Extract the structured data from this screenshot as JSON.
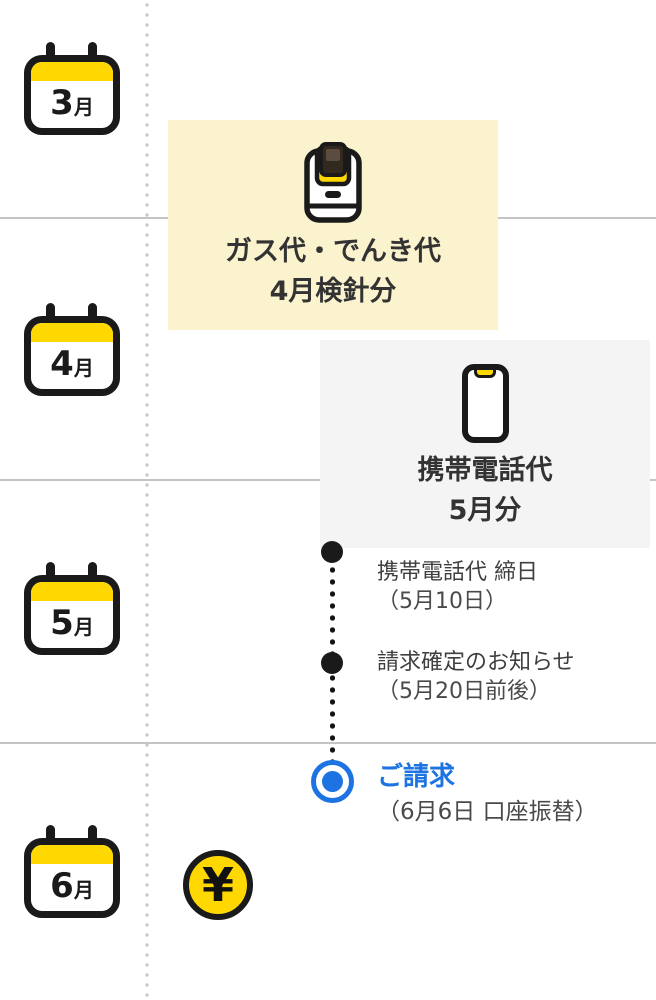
{
  "months": [
    {
      "num": "3",
      "unit": "月"
    },
    {
      "num": "4",
      "unit": "月"
    },
    {
      "num": "5",
      "unit": "月"
    },
    {
      "num": "6",
      "unit": "月"
    }
  ],
  "cards": [
    {
      "name": "gas-electric",
      "icon": "gas-meter-icon",
      "line1": "ガス代・でんき代",
      "line2": "4月検針分",
      "bg": "#FAF3CE"
    },
    {
      "name": "mobile-phone",
      "icon": "smartphone-icon",
      "line1": "携帯電話代",
      "line2": "5月分",
      "bg": "#F4F4F4"
    }
  ],
  "events": [
    {
      "marker": "black-dot",
      "label": "携帯電話代 締日",
      "date": "（5月10日）"
    },
    {
      "marker": "black-dot",
      "label": "請求確定のお知らせ",
      "date": "（5月20日前後）"
    },
    {
      "marker": "blue-target-dot",
      "label": "ご請求",
      "date": "（6月6日 口座振替）"
    }
  ],
  "coin": {
    "symbol": "¥"
  },
  "colors": {
    "accent_yellow": "#FFD802",
    "pale_yellow_card": "#FAF3CE",
    "gray_card": "#F4F4F4",
    "ink": "#1A1A1A",
    "text": "#3F3F3F",
    "blue": "#1D73E2",
    "divider": "#C4C4C4"
  }
}
